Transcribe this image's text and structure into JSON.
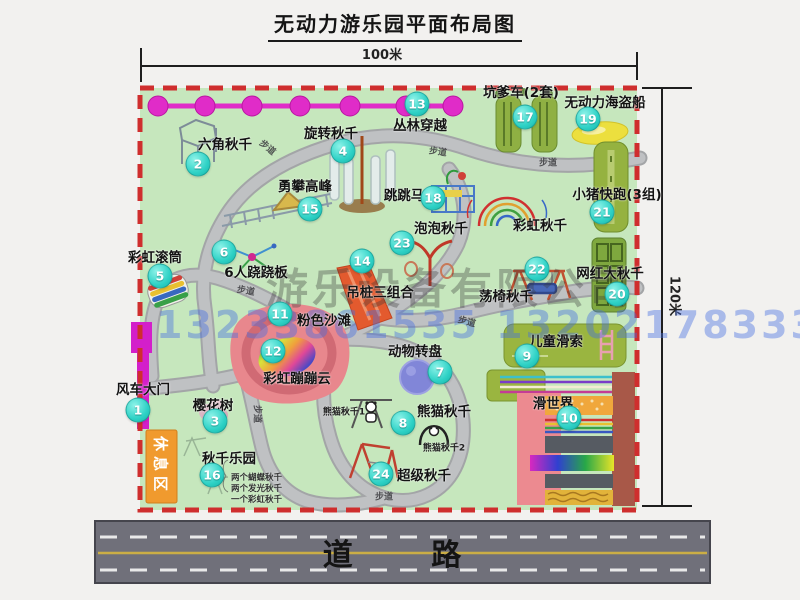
{
  "title": "无动力游乐园平面布局图",
  "scale": {
    "width": "100米",
    "height": "120米"
  },
  "road": {
    "label": "道 路"
  },
  "watermarks": {
    "company": "游乐设备有限公司",
    "phone": "13233861535 13202178333"
  },
  "colors": {
    "map_green": "#c6e7bd",
    "border_red": "#cf2e2e",
    "path_gray": "#bdbfc1",
    "magenta": "#d920cb",
    "badge_cyan": "#2fd2c6",
    "rest_orange": "#f09a2e",
    "road_gray": "#70707a",
    "beach_pink": "#e8878d",
    "block_olive": "#95b240"
  },
  "map": {
    "rest_area_label": "休息区",
    "walkway_text": "步道",
    "walkways": [
      {
        "x": 268,
        "y": 147,
        "rot": 40
      },
      {
        "x": 438,
        "y": 151,
        "rot": 8
      },
      {
        "x": 548,
        "y": 162,
        "rot": 0
      },
      {
        "x": 246,
        "y": 290,
        "rot": 10
      },
      {
        "x": 258,
        "y": 414,
        "rot": 90
      },
      {
        "x": 384,
        "y": 496,
        "rot": 0
      },
      {
        "x": 467,
        "y": 321,
        "rot": 15
      }
    ],
    "items": [
      {
        "id": "1",
        "label": "风车大门",
        "lx": 143,
        "ly": 388,
        "bx": 138,
        "by": 410
      },
      {
        "id": "2",
        "label": "六角秋千",
        "lx": 225,
        "ly": 143,
        "bx": 198,
        "by": 164
      },
      {
        "id": "3",
        "label": "樱花树",
        "lx": 213,
        "ly": 404,
        "bx": 215,
        "by": 421
      },
      {
        "id": "4",
        "label": "旋转秋千",
        "lx": 331,
        "ly": 132,
        "bx": 343,
        "by": 151
      },
      {
        "id": "5",
        "label": "彩虹滚筒",
        "lx": 155,
        "ly": 256,
        "bx": 160,
        "by": 276
      },
      {
        "id": "6",
        "label": "6人跷跷板",
        "lx": 256,
        "ly": 271,
        "bx": 224,
        "by": 252
      },
      {
        "id": "7",
        "label": "动物转盘",
        "lx": 415,
        "ly": 350,
        "bx": 440,
        "by": 372
      },
      {
        "id": "8",
        "label": "熊猫秋千",
        "lx": 444,
        "ly": 410,
        "bx": 403,
        "by": 423
      },
      {
        "id": "9",
        "label": "儿童滑索",
        "lx": 556,
        "ly": 340,
        "bx": 527,
        "by": 356
      },
      {
        "id": "10",
        "label": "滑世界",
        "lx": 553,
        "ly": 402,
        "bx": 569,
        "by": 418
      },
      {
        "id": "11",
        "label": "粉色沙滩",
        "lx": 324,
        "ly": 319,
        "bx": 280,
        "by": 314
      },
      {
        "id": "12",
        "label": "彩虹蹦蹦云",
        "lx": 297,
        "ly": 377,
        "bx": 273,
        "by": 351
      },
      {
        "id": "13",
        "label": "丛林穿越",
        "lx": 420,
        "ly": 124,
        "bx": 417,
        "by": 104
      },
      {
        "id": "14",
        "label": "吊桩三组合",
        "lx": 380,
        "ly": 291,
        "bx": 362,
        "by": 261
      },
      {
        "id": "15",
        "label": "勇攀高峰",
        "lx": 305,
        "ly": 185,
        "bx": 310,
        "by": 209
      },
      {
        "id": "16",
        "label": "秋千乐园",
        "lx": 229,
        "ly": 457,
        "bx": 212,
        "by": 475
      },
      {
        "id": "17",
        "label": "坑爹车(2套)",
        "lx": 521,
        "ly": 91,
        "bx": 525,
        "by": 117
      },
      {
        "id": "18",
        "label": "跳跳马",
        "lx": 404,
        "ly": 194,
        "bx": 433,
        "by": 198
      },
      {
        "id": "19",
        "label": "无动力海盗船",
        "lx": 605,
        "ly": 101,
        "bx": 588,
        "by": 119
      },
      {
        "id": "20",
        "label": "网红大秋千",
        "lx": 610,
        "ly": 272,
        "bx": 617,
        "by": 294
      },
      {
        "id": "21",
        "label": "小猪快跑(3组)",
        "lx": 617,
        "ly": 193,
        "bx": 602,
        "by": 212
      },
      {
        "id": "22",
        "label": "荡椅秋千",
        "lx": 506,
        "ly": 295,
        "bx": 537,
        "by": 269
      },
      {
        "id": "23",
        "label": "泡泡秋千",
        "lx": 441,
        "ly": 227,
        "bx": 402,
        "by": 243
      },
      {
        "id": "24",
        "label": "超级秋千",
        "lx": 424,
        "ly": 474,
        "bx": 381,
        "by": 474
      },
      {
        "id": "",
        "label": "彩虹秋千",
        "lx": 540,
        "ly": 224,
        "bx": null,
        "by": null
      }
    ],
    "sub_labels": [
      {
        "label": "熊猫秋千1",
        "x": 344,
        "y": 411
      },
      {
        "label": "熊猫秋千2",
        "x": 444,
        "y": 447
      }
    ],
    "swing_park_notes": [
      "两个蝴蝶秋千",
      "两个发光秋千",
      "一个彩虹秋千"
    ]
  }
}
